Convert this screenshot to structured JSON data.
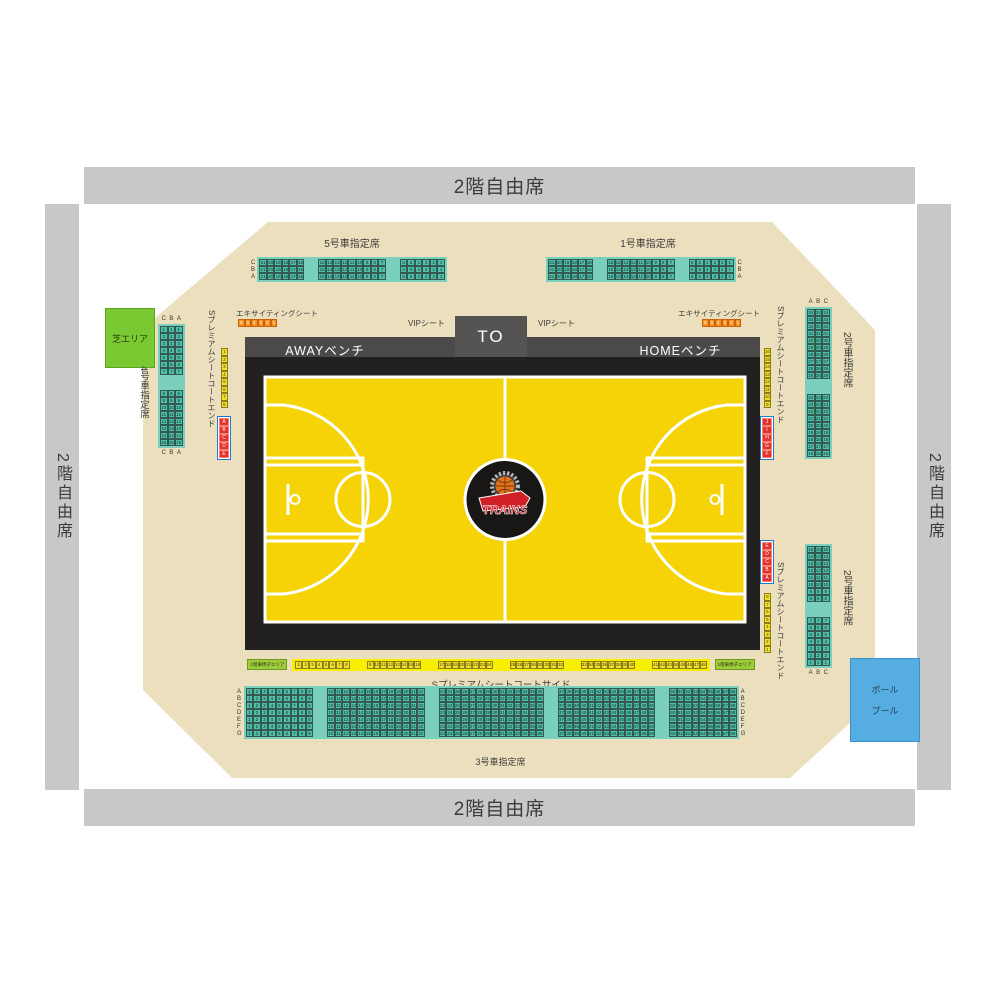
{
  "stands": {
    "top": "2階自由席",
    "bottom": "2階自由席",
    "left": "2階自由席",
    "right": "2階自由席"
  },
  "colors": {
    "stand_gray": "#c8c8c8",
    "floor_beige": "#ecdfbd",
    "teal_cell": "#4ec0a9",
    "teal_strip": "#7bcfbd",
    "court_yellow": "#f5d306",
    "court_black": "#232120",
    "bench_gray": "#4c4a48",
    "vip_red": "#e8332a",
    "orange": "#f5941f",
    "seat_yellow": "#f2e129",
    "block_border_blue": "#1f7ad4",
    "grass_green": "#7ac832",
    "pool_blue": "#55ade2",
    "wheelchair_green": "#9ccb3b"
  },
  "top_sections": {
    "car5": {
      "label": "5号車指定席",
      "row_labels": [
        "C",
        "B",
        "A"
      ],
      "label_side": "left",
      "blocks": [
        [
          21,
          20,
          19,
          18,
          17,
          16
        ],
        [
          15,
          14,
          13,
          12,
          11,
          10,
          9,
          8,
          7
        ],
        [
          6,
          5,
          4,
          3,
          2,
          1
        ]
      ]
    },
    "car1": {
      "label": "1号車指定席",
      "row_labels": [
        "C",
        "B",
        "A"
      ],
      "label_side": "right",
      "blocks": [
        [
          21,
          20,
          19,
          18,
          17,
          16
        ],
        [
          15,
          14,
          13,
          12,
          11,
          10,
          9,
          8,
          7
        ],
        [
          6,
          5,
          4,
          3,
          2,
          1
        ]
      ]
    }
  },
  "left_sections": {
    "grass": {
      "label": "芝エリア"
    },
    "car4": {
      "label": "4号車指定席",
      "col_labels": [
        "C",
        "B",
        "A"
      ],
      "label_pos": "both",
      "blocks": [
        [
          1,
          2,
          3,
          4,
          5,
          6,
          7
        ],
        [
          8,
          9,
          10,
          11,
          12,
          13,
          14,
          15
        ]
      ]
    },
    "premium_end": {
      "label": "Sプレミアムシートコートエンド",
      "yellow_seats": [
        1,
        2,
        3,
        4,
        5,
        6,
        7,
        8
      ],
      "red_seats": [
        "A",
        "B",
        "C",
        "D",
        "E"
      ]
    }
  },
  "right_sections": {
    "car2_upper": {
      "label": "2号車指定席",
      "col_labels": [
        "A",
        "B",
        "C"
      ],
      "label_pos": "top",
      "blocks": [
        [
          34,
          33,
          32,
          31,
          30,
          29,
          28,
          27,
          26,
          25
        ],
        [
          24,
          23,
          22,
          21,
          20,
          19,
          18,
          17,
          16
        ]
      ]
    },
    "car2_lower": {
      "label": "2号車指定席",
      "col_labels": [
        "A",
        "B",
        "C"
      ],
      "label_pos": "bottom",
      "blocks": [
        [
          15,
          14,
          13,
          12,
          11,
          10,
          9,
          8
        ],
        [
          7,
          6,
          5,
          4,
          3,
          2,
          1
        ]
      ]
    },
    "premium_end_upper": {
      "label": "Sプレミアムシートコートエンド",
      "yellow_seats": [
        16,
        15,
        14,
        13,
        12,
        11,
        10,
        9
      ],
      "red_seats": [
        "J",
        "I",
        "H",
        "G",
        "F"
      ]
    },
    "premium_end_lower": {
      "label": "Sプレミアムシートコートエンド",
      "red_seats": [
        "E",
        "D",
        "C",
        "B",
        "A"
      ],
      "yellow_seats": [
        8,
        7,
        6,
        5,
        4,
        3,
        2,
        1
      ]
    },
    "ball_pool": {
      "line1": "ボール",
      "line2": "プール"
    }
  },
  "court": {
    "to_label": "TO",
    "away_label": "AWAYベンチ",
    "home_label": "HOMEベンチ",
    "logo_text": "TRAINS",
    "exciting_left": {
      "label": "エキサイティングシート",
      "seats": [
        6,
        5,
        4,
        3,
        2,
        1
      ]
    },
    "exciting_right": {
      "label": "エキサイティングシート",
      "seats": [
        6,
        5,
        4,
        3,
        2,
        1
      ]
    },
    "vip_left": {
      "label": "VIPシート",
      "seats": [
        6,
        5,
        4,
        3,
        2,
        1
      ]
    },
    "vip_right": {
      "label": "VIPシート",
      "seats": [
        6,
        5,
        4,
        3,
        2,
        1
      ]
    }
  },
  "bottom_sections": {
    "premium_side": {
      "label": "Sプレミアムシートコートサイド",
      "wheelchair_label": "1階車椅子エリア",
      "blocks": [
        [
          1,
          2,
          3,
          4,
          5,
          6,
          7,
          8
        ],
        [
          9,
          10,
          11,
          12,
          13,
          14,
          15,
          16
        ],
        [
          17,
          18,
          19,
          20,
          21,
          22,
          23,
          24
        ],
        [
          25,
          26,
          27,
          28,
          29,
          30,
          31,
          32
        ],
        [
          33,
          34,
          35,
          36,
          37,
          38,
          39,
          40
        ],
        [
          41,
          42,
          43,
          44,
          45,
          46,
          47,
          48
        ]
      ]
    },
    "car3": {
      "label": "3号車指定席",
      "row_labels": [
        "A",
        "B",
        "C",
        "D",
        "E",
        "F",
        "G"
      ],
      "label_side": "both",
      "blocks": [
        [
          1,
          2,
          3,
          4,
          5,
          6,
          7,
          8,
          9
        ],
        [
          10,
          11,
          12,
          13,
          14,
          15,
          16,
          17,
          18,
          19,
          20,
          21,
          22
        ],
        [
          23,
          24,
          25,
          26,
          27,
          28,
          29,
          30,
          31,
          32,
          33,
          34,
          35,
          36
        ],
        [
          37,
          38,
          39,
          40,
          41,
          42,
          43,
          44,
          45,
          46,
          47,
          48,
          49
        ],
        [
          50,
          51,
          52,
          53,
          54,
          55,
          56,
          57,
          58
        ]
      ]
    }
  }
}
